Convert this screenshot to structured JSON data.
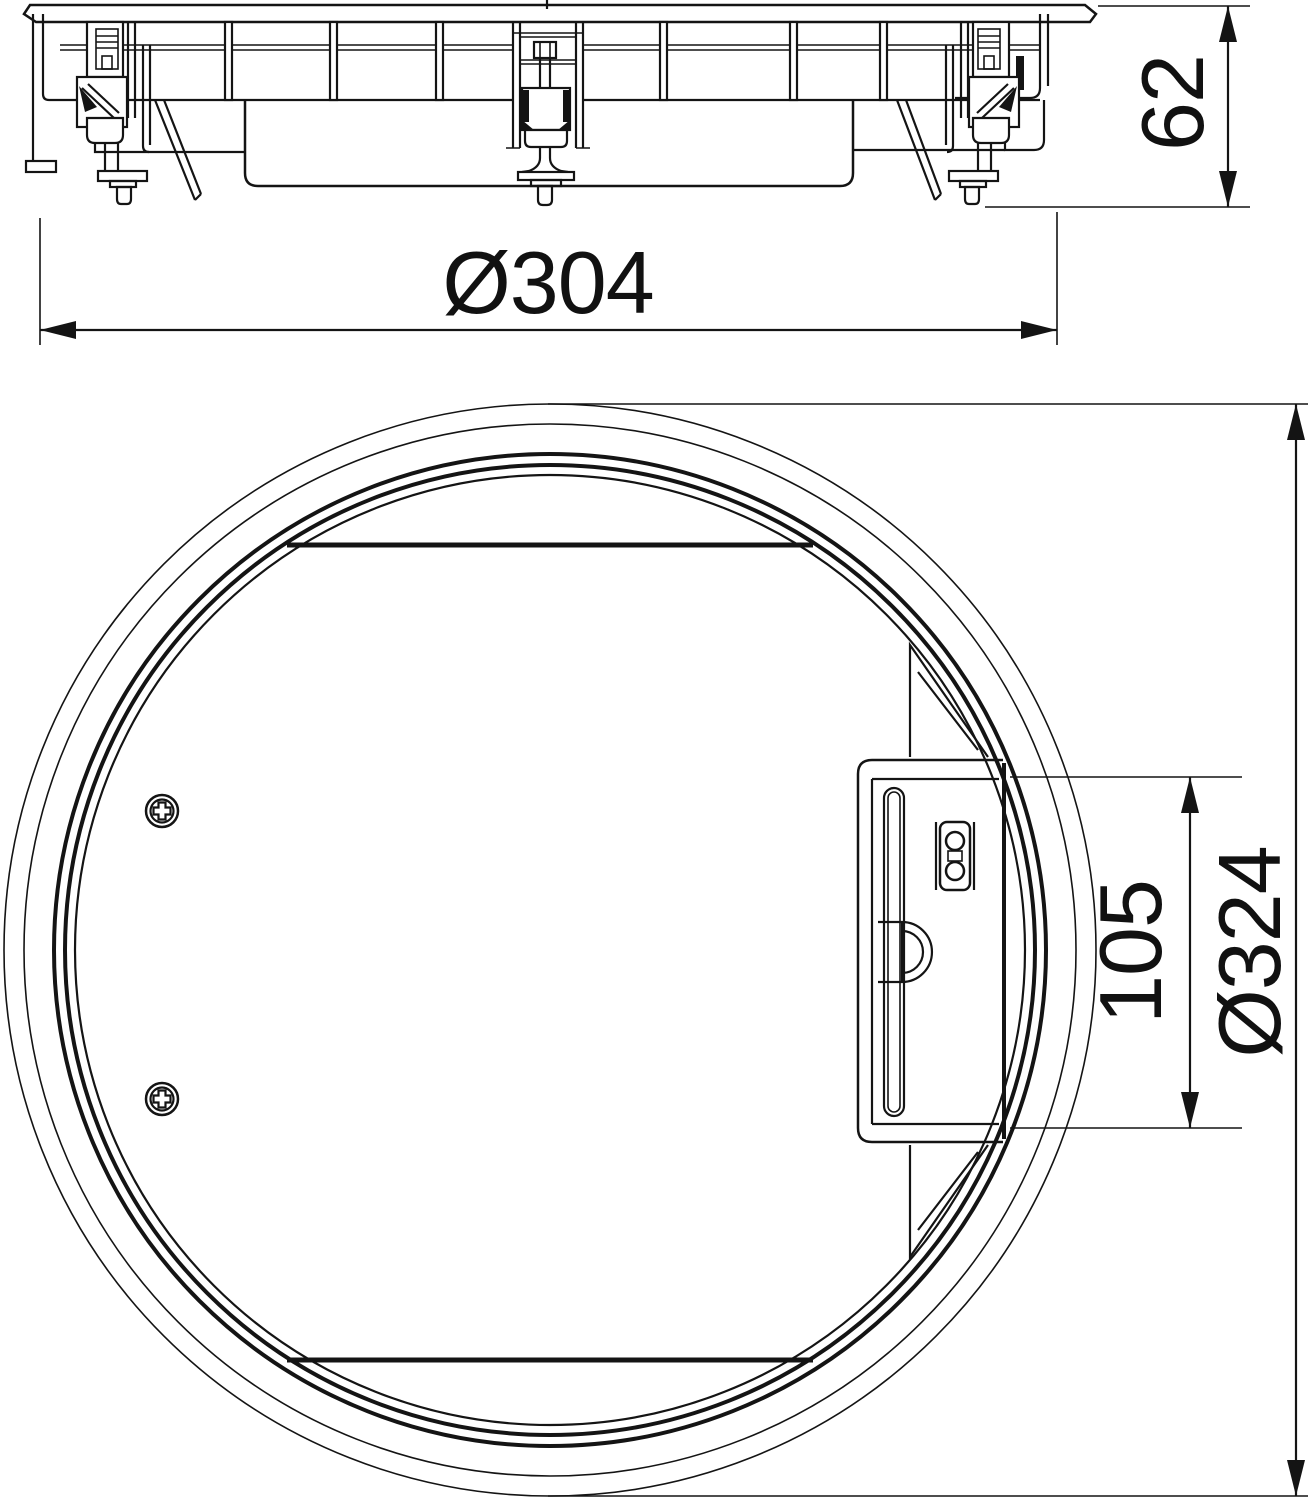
{
  "drawing": {
    "type": "technical-2d-drawing",
    "description": "Round floor-box cover cassette, two orthographic views (side elevation and plan of underside)",
    "background_color": "#ffffff",
    "line_color": "#141414",
    "views": [
      {
        "id": "side-view",
        "name": "Side elevation with fixing clamps",
        "dimensions": [
          {
            "label": "Ø304",
            "value": 304,
            "unit": "mm",
            "kind": "diameter",
            "orientation": "horizontal"
          },
          {
            "label": "62",
            "value": 62,
            "unit": "mm",
            "kind": "height",
            "orientation": "vertical"
          }
        ]
      },
      {
        "id": "plan-view",
        "name": "Plan view of cover underside with latch",
        "dimensions": [
          {
            "label": "105",
            "value": 105,
            "unit": "mm",
            "kind": "latch length",
            "orientation": "vertical"
          },
          {
            "label": "Ø324",
            "value": 324,
            "unit": "mm",
            "kind": "diameter",
            "orientation": "vertical"
          }
        ]
      }
    ]
  },
  "dim_labels": {
    "d304": "Ø304",
    "h62": "62",
    "l105": "105",
    "d324": "Ø324"
  }
}
